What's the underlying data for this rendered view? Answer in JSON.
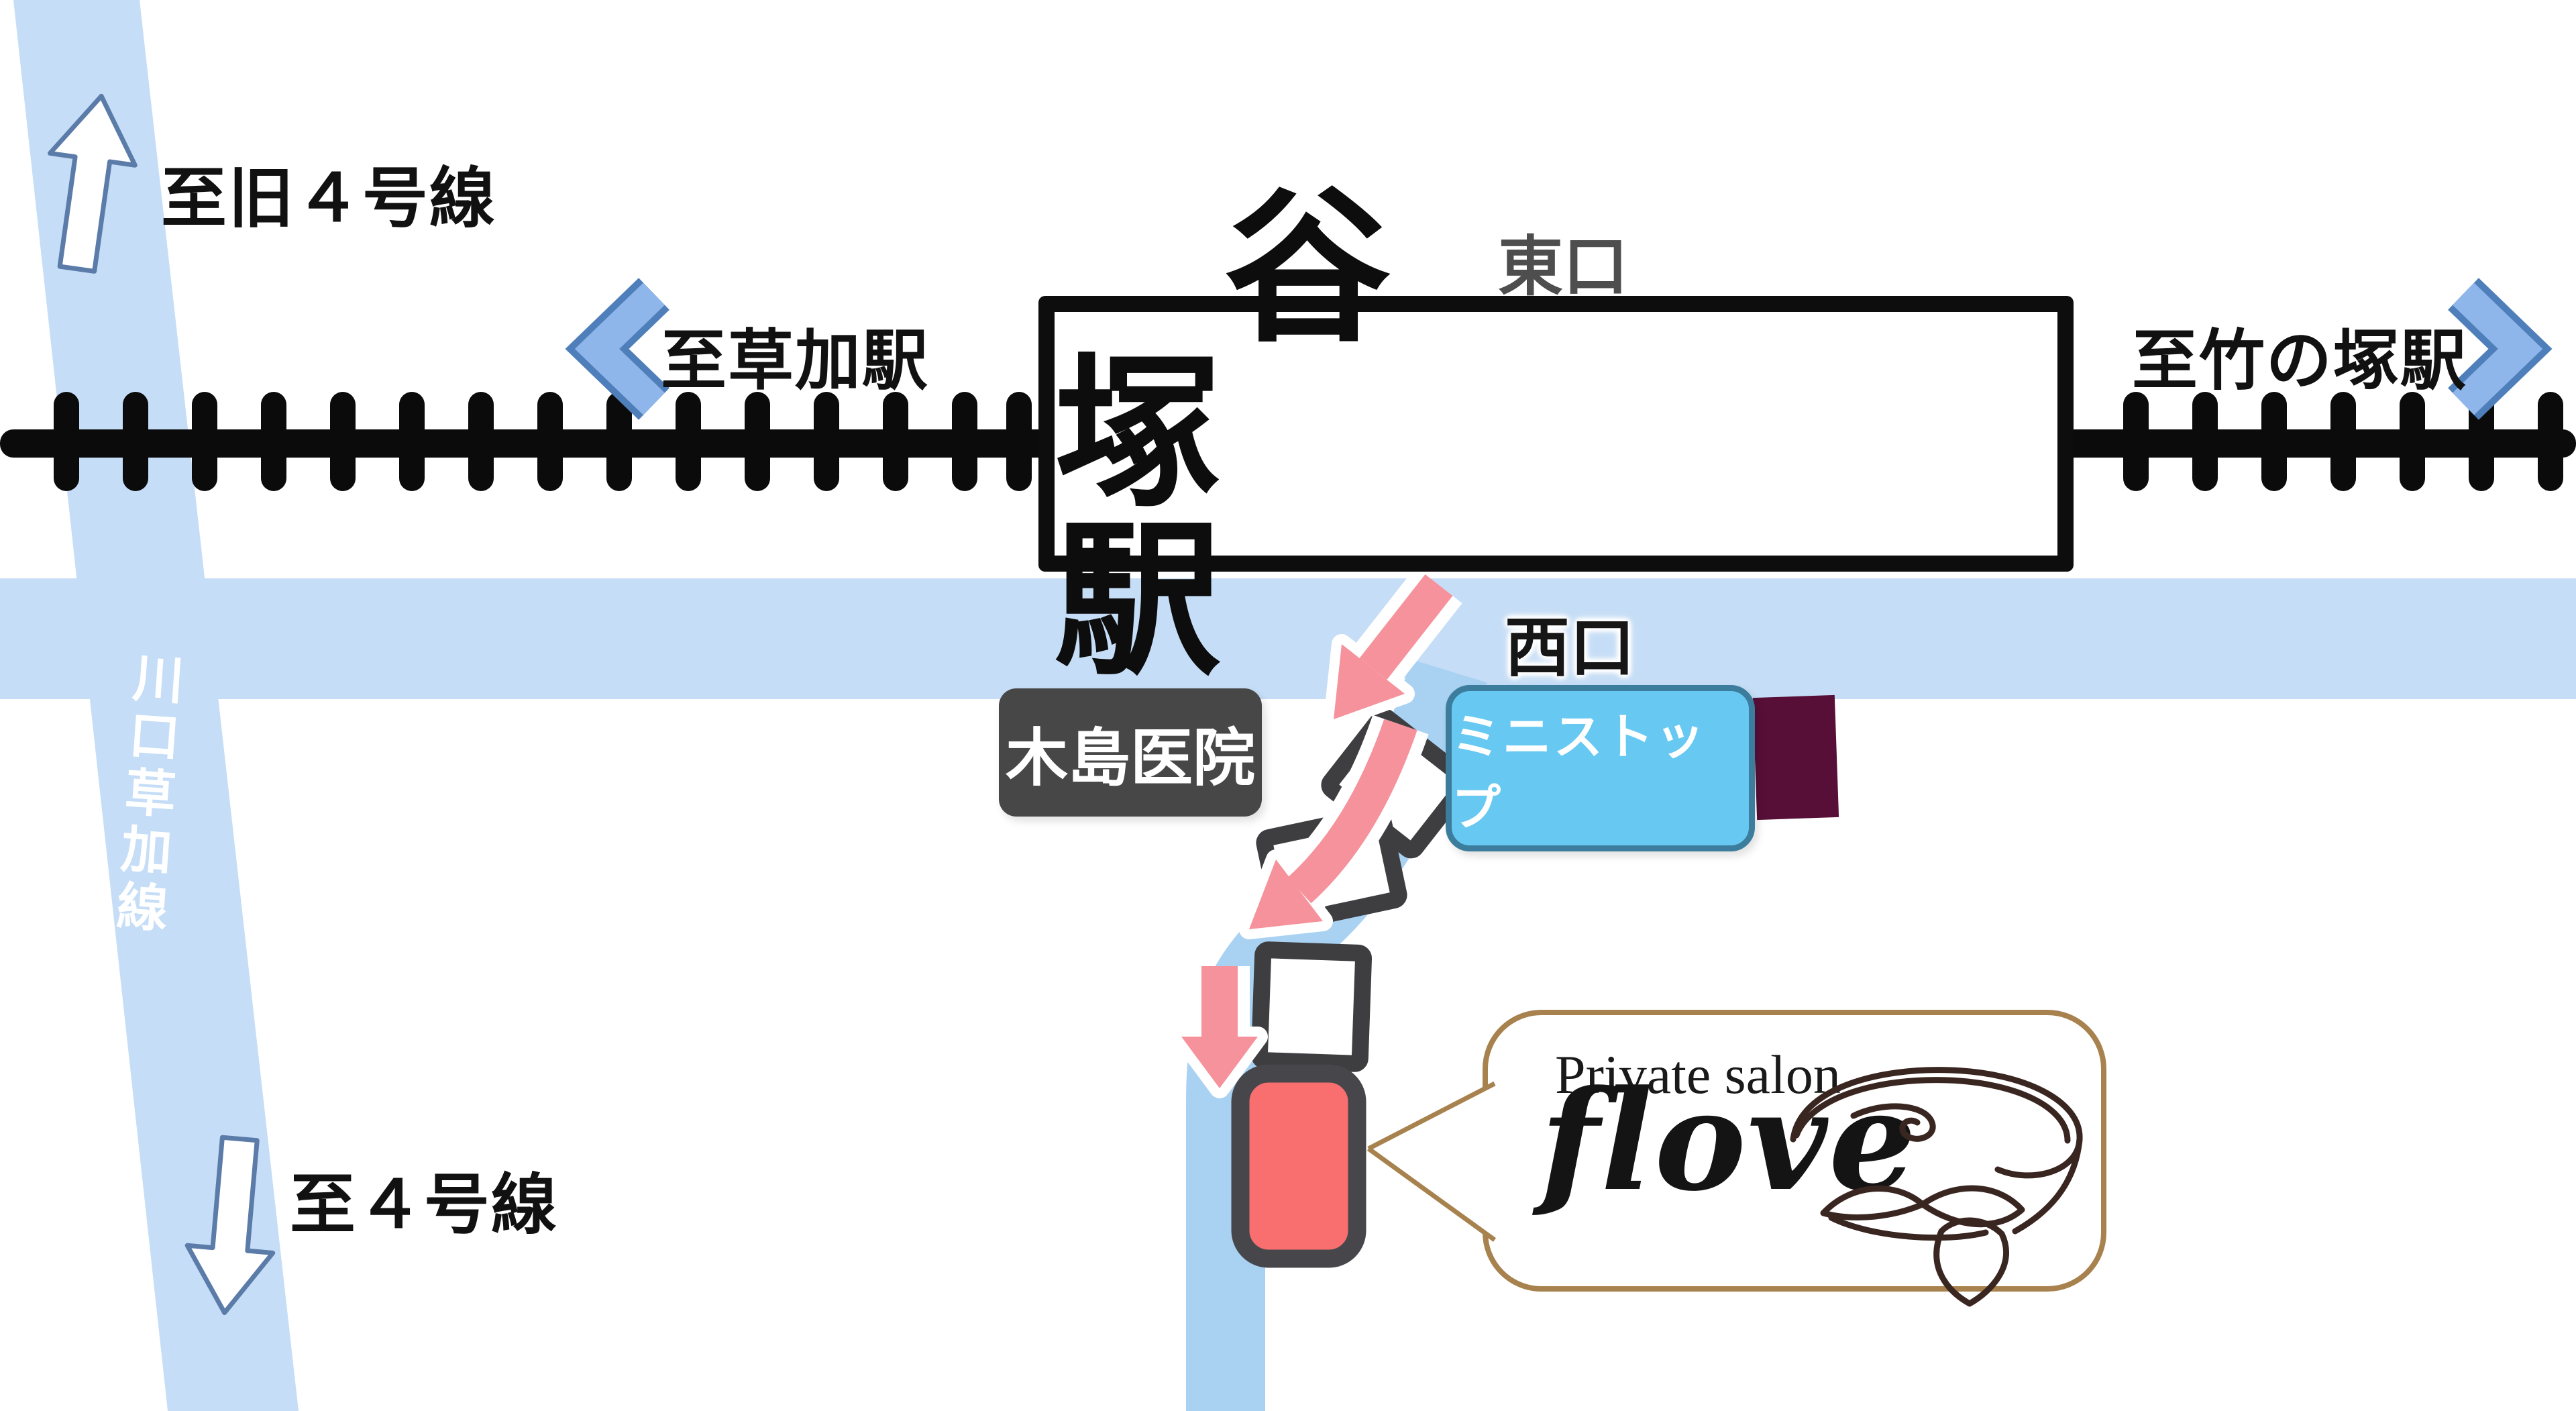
{
  "station": {
    "name": "谷　塚　駅",
    "east_exit_label": "東口",
    "west_exit_label": "西口"
  },
  "railway": {
    "left_destination": "至草加駅",
    "right_destination": "至竹の塚駅"
  },
  "roads": {
    "vertical_road_name": "川口草加線",
    "north_label": "至旧４号線",
    "south_label": "至４号線"
  },
  "landmarks": {
    "clinic": "木島医院",
    "convenience_store": "ミニストップ"
  },
  "salon_bubble": {
    "tagline": "Private salon",
    "name": "flove"
  },
  "colors": {
    "road_blue": "#c5ddf6",
    "branch_road_blue": "#a9d2f2",
    "railway_black": "#0b0b0b",
    "route_arrow_pink": "#f5929b",
    "salon_marker_red": "#f96f70",
    "marker_border_gray": "#47474b",
    "ministop_blue": "#67c9f1",
    "clinic_gray": "#474747",
    "dark_building_maroon": "#570f37",
    "bubble_border_brown": "#a8824e",
    "chevron_blue": "#8fb6ea"
  }
}
